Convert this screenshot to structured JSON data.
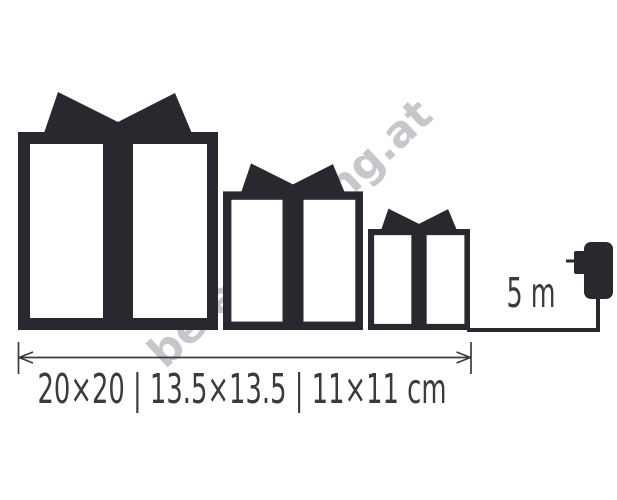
{
  "theme": {
    "paper": "#ffffff",
    "ink": "#2a272e",
    "line": "#3c3a40",
    "watermark_color": "#c6c6cb"
  },
  "watermark": {
    "text": "beleuchtung.at"
  },
  "diagram": {
    "boxes": [
      {
        "icon": "gift-box-large-icon",
        "size_label": "20×20"
      },
      {
        "icon": "gift-box-medium-icon",
        "size_label": "13.5×13.5"
      },
      {
        "icon": "gift-box-small-icon",
        "size_label": "11×11 cm"
      }
    ],
    "cable": {
      "icon": "power-adapter-icon",
      "length_label": "5 m"
    },
    "dimensions_label": "20×20 | 13.5×13.5 | 11×11 cm",
    "dimensions_separator": "|",
    "unit": "cm"
  }
}
